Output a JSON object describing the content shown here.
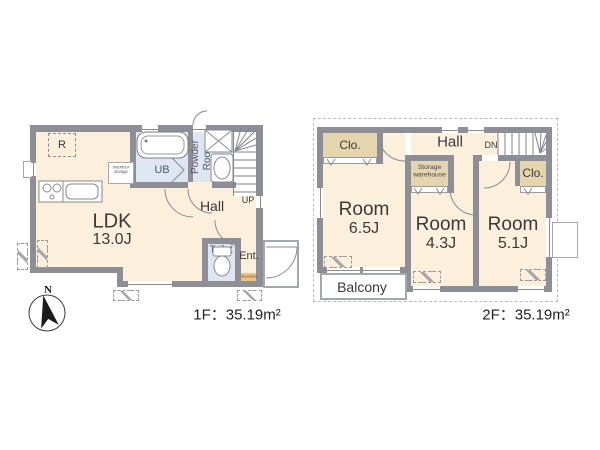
{
  "colors": {
    "wall": "#8e8e96",
    "room_fill": "#fcefdb",
    "closet_fill": "#e4d5af",
    "wet_area_fill": "#dde6f1",
    "shoesbox_fill": "#efc185",
    "outline": "#8a8a8a",
    "text": "#333333"
  },
  "floor1": {
    "area_label": "1F：35.19m²",
    "compass_label": "N",
    "ldk": {
      "name": "LDK",
      "size": "13.0J"
    },
    "hall": "Hall",
    "up": "UP",
    "unit_bath": "UB",
    "powder_room": {
      "line1": "Powder",
      "line2": "Room"
    },
    "toilet": "Toilet",
    "entrance": "Ent.",
    "shoesbox": "Shoesbox",
    "refrigerator": "R",
    "underfloor_storage": {
      "line1": "Interfloor",
      "line2": "storage"
    }
  },
  "floor2": {
    "area_label": "2F：35.19m²",
    "room_650": {
      "name": "Room",
      "size": "6.5J"
    },
    "room_430": {
      "name": "Room",
      "size": "4.3J"
    },
    "room_510": {
      "name": "Room",
      "size": "5.1J"
    },
    "hall": "Hall",
    "dn": "DN",
    "closet_left": "Clo.",
    "closet_right": "Clo.",
    "storage": {
      "line1": "Storage",
      "line2": "warehouse"
    },
    "balcony": "Balcony"
  }
}
